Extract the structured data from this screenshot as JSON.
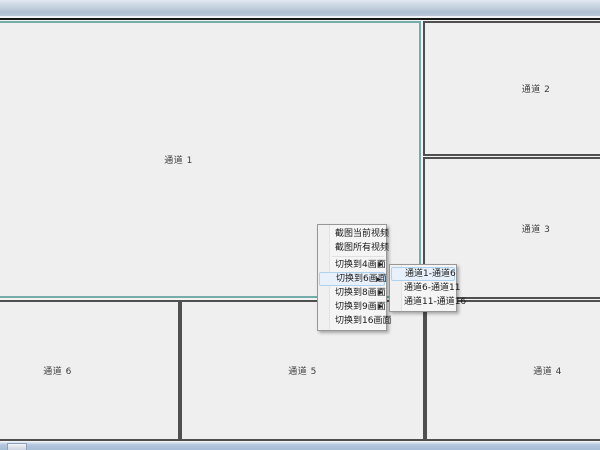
{
  "colors": {
    "selected-border": "#74aca9",
    "panel-bg": "#efefef",
    "menu-highlight": "#e8f1fb"
  },
  "channels": [
    {
      "label": "通道 1",
      "selected": true
    },
    {
      "label": "通道 2",
      "selected": false
    },
    {
      "label": "通道 3",
      "selected": false
    },
    {
      "label": "通道 4",
      "selected": false
    },
    {
      "label": "通道 5",
      "selected": false
    },
    {
      "label": "通道 6",
      "selected": false
    }
  ],
  "context_menu": {
    "submenu_arrow": "▶",
    "items": [
      {
        "label": "截图当前视频",
        "has_submenu": false,
        "highlighted": false
      },
      {
        "label": "截图所有视频",
        "has_submenu": false,
        "highlighted": false
      },
      {
        "label": "切换到4画面",
        "has_submenu": true,
        "highlighted": false
      },
      {
        "label": "切换到6画面",
        "has_submenu": true,
        "highlighted": true
      },
      {
        "label": "切换到8画面",
        "has_submenu": true,
        "highlighted": false
      },
      {
        "label": "切换到9画面",
        "has_submenu": true,
        "highlighted": false
      },
      {
        "label": "切换到16画面",
        "has_submenu": false,
        "highlighted": false
      }
    ]
  },
  "submenu": {
    "items": [
      {
        "label": "通道1-通道6",
        "highlighted": true
      },
      {
        "label": "通道6-通道11",
        "highlighted": false
      },
      {
        "label": "通道11-通道16",
        "highlighted": false
      }
    ]
  }
}
